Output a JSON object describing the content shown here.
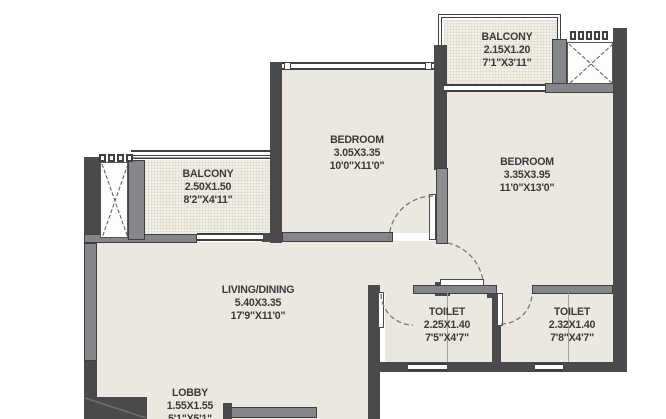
{
  "plan": {
    "title": "apartment-floor-plan",
    "rooms": [
      {
        "id": "balcony-top",
        "name": "BALCONY",
        "dim_m": "2.15X1.20",
        "dim_ft": "7'1\"X3'11\""
      },
      {
        "id": "balcony-left",
        "name": "BALCONY",
        "dim_m": "2.50X1.50",
        "dim_ft": "8'2\"X4'11\""
      },
      {
        "id": "bedroom-1",
        "name": "BEDROOM",
        "dim_m": "3.05X3.35",
        "dim_ft": "10'0\"X11'0\""
      },
      {
        "id": "bedroom-2",
        "name": "BEDROOM",
        "dim_m": "3.35X3.95",
        "dim_ft": "11'0\"X13'0\""
      },
      {
        "id": "living-dining",
        "name": "LIVING/DINING",
        "dim_m": "5.40X3.35",
        "dim_ft": "17'9\"X11'0\""
      },
      {
        "id": "toilet-1",
        "name": "TOILET",
        "dim_m": "2.25X1.40",
        "dim_ft": "7'5\"X4'7\""
      },
      {
        "id": "toilet-2",
        "name": "TOILET",
        "dim_m": "2.32X1.40",
        "dim_ft": "7'8\"X4'7\""
      },
      {
        "id": "lobby",
        "name": "LOBBY",
        "dim_m": "1.55X1.55",
        "dim_ft": "5'1\"X5'1\""
      }
    ],
    "colors": {
      "wall_dark": "#4a4a4c",
      "wall_medium": "#85868a",
      "floor": "#ece8df",
      "balcony_floor": "#f2efe7",
      "text": "#3a3a3c",
      "outside": "#ffffff"
    }
  }
}
